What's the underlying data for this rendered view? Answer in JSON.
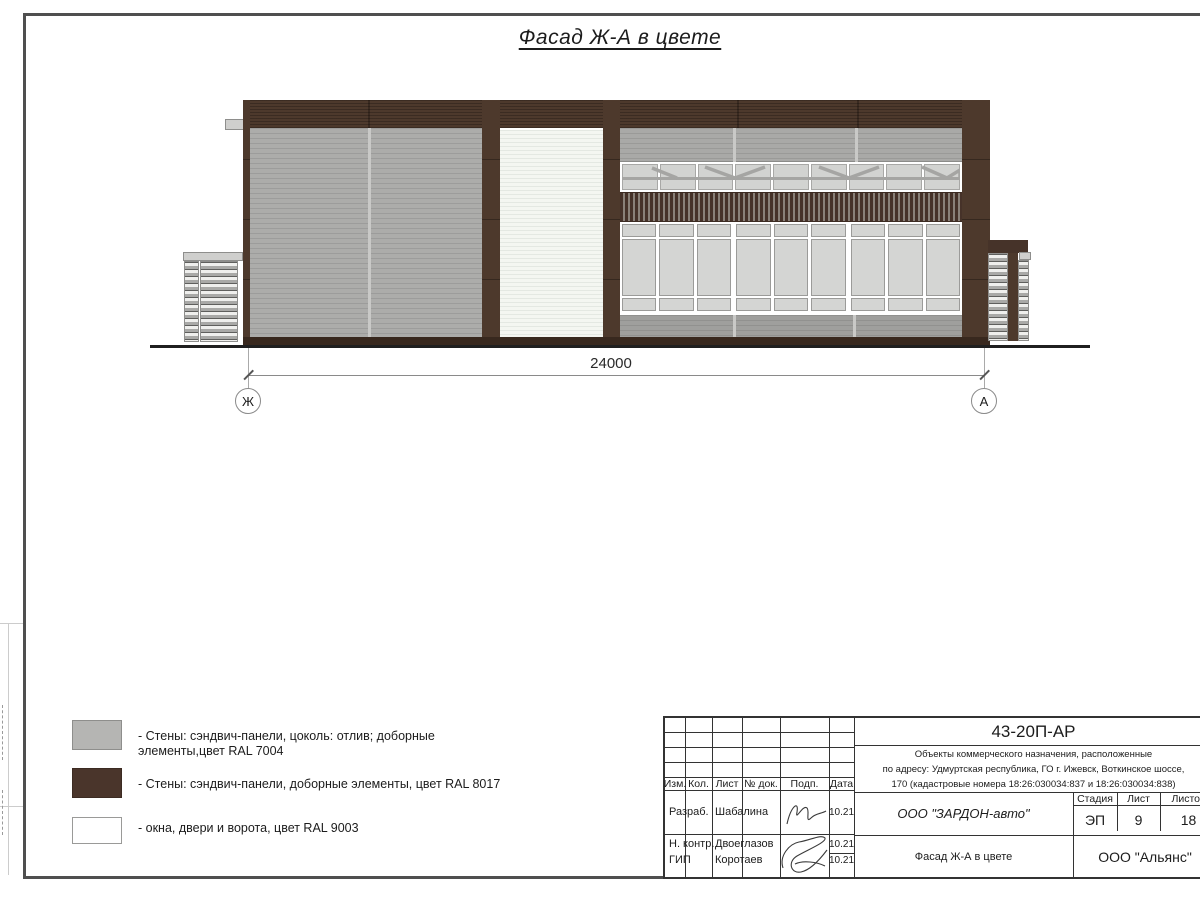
{
  "page": {
    "title": "Фасад Ж-А в цвете"
  },
  "drawing": {
    "dimension_label": "24000",
    "axis_left": "Ж",
    "axis_right": "А"
  },
  "colors": {
    "panel_gray": "#acacaa",
    "panel_gray_top": "#a9a9a7",
    "panel_brown": "#4d392c",
    "panel_brown_dark": "#38281e",
    "panel_white": "#f4f6f1",
    "glass": "#d4d5d3"
  },
  "legend": {
    "items": [
      {
        "color": "#b5b5b3",
        "label": "- Стены: сэндвич-панели, цоколь: отлив; доборные элементы,цвет RAL 7004"
      },
      {
        "color": "#4a352b",
        "label": "- Стены: сэндвич-панели, доборные элементы, цвет RAL 8017"
      },
      {
        "color": "#ffffff",
        "label": "- окна, двери и ворота, цвет RAL 9003"
      }
    ]
  },
  "title_block": {
    "doc_number": "43-20П-АР",
    "description_lines": [
      "Объекты коммерческого назначения, расположенные",
      "по адресу: Удмуртская республика, ГО г. Ижевск, Воткинское шоссе,",
      "170 (кадастровые номера 18:26:030034:837 и 18:26:030034:838)"
    ],
    "header_cells": [
      "Изм.",
      "Кол.",
      "Лист",
      "№ док.",
      "Подп.",
      "Дата"
    ],
    "rows": [
      {
        "role": "Разраб.",
        "name": "Шабалина",
        "date": "10.21"
      },
      {
        "role": "Н. контр.",
        "name": "Двоеглазов",
        "date": "10.21"
      },
      {
        "role": "ГИП",
        "name": "Коротаев",
        "date": "10.21"
      }
    ],
    "company": "ООО \"ЗАРДОН-авто\"",
    "stage_label": "Стадия",
    "sheet_label": "Лист",
    "sheets_label": "Листов",
    "stage": "ЭП",
    "sheet": "9",
    "sheets": "18",
    "drawing_title": "Фасад Ж-А в цвете",
    "contractor": "ООО \"Альянс\""
  }
}
